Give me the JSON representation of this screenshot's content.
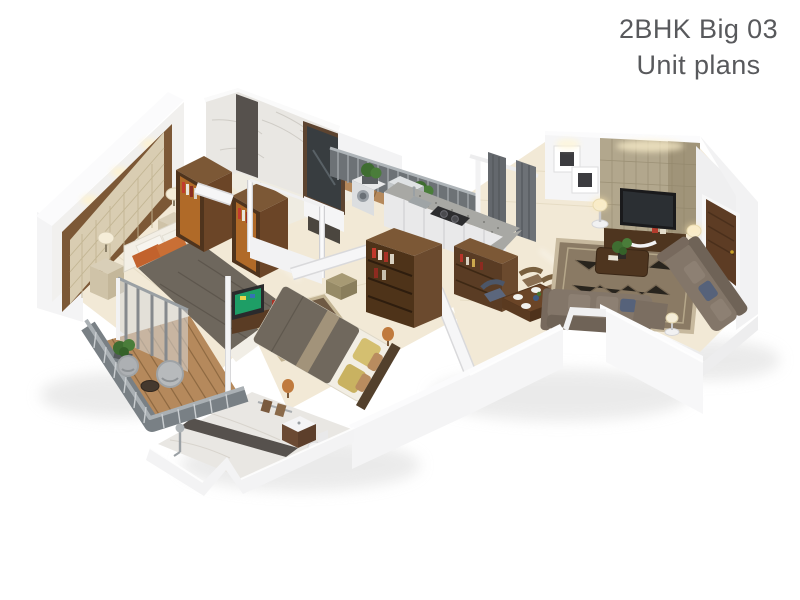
{
  "title": {
    "line1": "2BHK Big 03",
    "line2": "Unit plans"
  },
  "palette": {
    "background": "#ffffff",
    "title_text": "#58595c",
    "floor_cream": "#f2e9d6",
    "wall_white": "#f5f5f6",
    "wood_dark": "#5a3c24",
    "wood_frame": "#7c5836",
    "deck_wood": "#b5895c",
    "marble_light": "#e9e7e3",
    "marble_dark": "#56514d",
    "accent_wall": "#b2a78d",
    "tufted_panel": "#d9cdb2",
    "rug_brown": "#8a7a64",
    "rug_border": "#c7b99e",
    "sofa_taupe": "#837669",
    "cushion_navy": "#56627a",
    "pillow_orange": "#c2622d",
    "pillow_yellow": "#d4bf70",
    "duvet_brown": "#6e675d",
    "railing_gray": "#6d7276",
    "curtain_gray": "#64686d",
    "door_brown": "#5d3c24",
    "plant_green": "#3f6d31",
    "lamp_shade": "#f5edd8",
    "tv_screen": "#1e9e66",
    "granite": "#a8a8a4"
  }
}
